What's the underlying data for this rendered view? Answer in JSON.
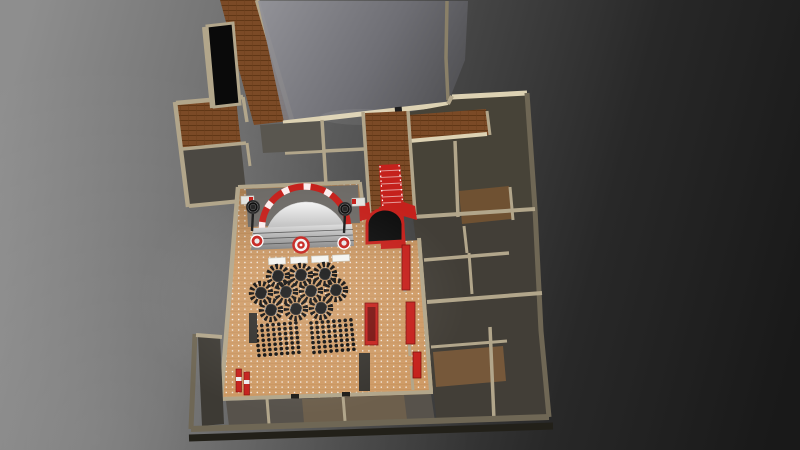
{
  "scene": {
    "name": "banquet-hall-3d-floorplan-render",
    "view": "isometric top-down 3d render",
    "visible_text": "none"
  },
  "colors": {
    "red": "#c5211c",
    "red_dark": "#7e0e0a",
    "wall": "#b2a68b",
    "wall_lit": "#ddd2b3",
    "wall_dark": "#6f6755",
    "hall_floor": "#cf9b66",
    "wood": "#7b4a26",
    "room_dark": "#474338",
    "stage_white": "#e9e9e7",
    "black": "#0c0c0c",
    "bg_light": "#8e8e8e",
    "bg_dark": "#191919"
  },
  "counts": {
    "round_tables": 10,
    "head_tables": 4,
    "seat_blocks": 2,
    "seats_per_block": 56,
    "speakers": 2,
    "red_drums": 2,
    "red_cabinets": 4,
    "fire_extinguishers": 2,
    "pillars": 2
  },
  "stage": {
    "speakers": [
      {
        "x": 253,
        "y": 207
      },
      {
        "x": 345,
        "y": 209
      }
    ],
    "drums": [
      {
        "x": 257,
        "y": 241
      },
      {
        "x": 344,
        "y": 243
      }
    ],
    "medallion": {
      "x": 301,
      "y": 245
    }
  },
  "furniture": {
    "head_tables": [
      {
        "x": 277,
        "y": 261,
        "a": -2.5
      },
      {
        "x": 299,
        "y": 260,
        "a": -2.5
      },
      {
        "x": 320,
        "y": 259,
        "a": -2.5
      },
      {
        "x": 341,
        "y": 258,
        "a": -2.5
      }
    ],
    "round_tables": [
      {
        "x": 278,
        "y": 276
      },
      {
        "x": 301,
        "y": 275
      },
      {
        "x": 325,
        "y": 274
      },
      {
        "x": 261,
        "y": 293
      },
      {
        "x": 286,
        "y": 292
      },
      {
        "x": 311,
        "y": 291
      },
      {
        "x": 336,
        "y": 290
      },
      {
        "x": 271,
        "y": 310
      },
      {
        "x": 296,
        "y": 309
      },
      {
        "x": 321,
        "y": 308
      }
    ],
    "seat_blocks": [
      {
        "x0": 256,
        "y0": 326,
        "cols": 8,
        "rows": 7,
        "dxc": 5.7,
        "dyc": -0.45,
        "dxr": 0.5,
        "dyr": 4.9,
        "r": 1.8
      },
      {
        "x0": 311,
        "y0": 323,
        "cols": 8,
        "rows": 7,
        "dxc": 5.7,
        "dyc": -0.45,
        "dxr": 0.5,
        "dyr": 4.9,
        "r": 1.8
      }
    ],
    "red_cabinets": [
      {
        "x": 402,
        "y": 245,
        "w": 8,
        "h": 45
      },
      {
        "x": 406,
        "y": 302,
        "w": 9,
        "h": 42
      },
      {
        "x": 413,
        "y": 352,
        "w": 8,
        "h": 26
      },
      {
        "x": 365,
        "y": 303,
        "w": 13,
        "h": 42
      }
    ],
    "fire_extinguishers": [
      {
        "x": 236,
        "y": 369
      },
      {
        "x": 244,
        "y": 372
      }
    ],
    "pillars": [
      {
        "x": 249,
        "y": 313,
        "w": 8,
        "h": 30,
        "fill": "#2f2d29"
      },
      {
        "x": 359,
        "y": 353,
        "w": 11,
        "h": 38,
        "fill": "#37342f"
      }
    ],
    "door_marks": [
      {
        "x": 291,
        "y": 394
      },
      {
        "x": 342,
        "y": 392
      }
    ]
  }
}
